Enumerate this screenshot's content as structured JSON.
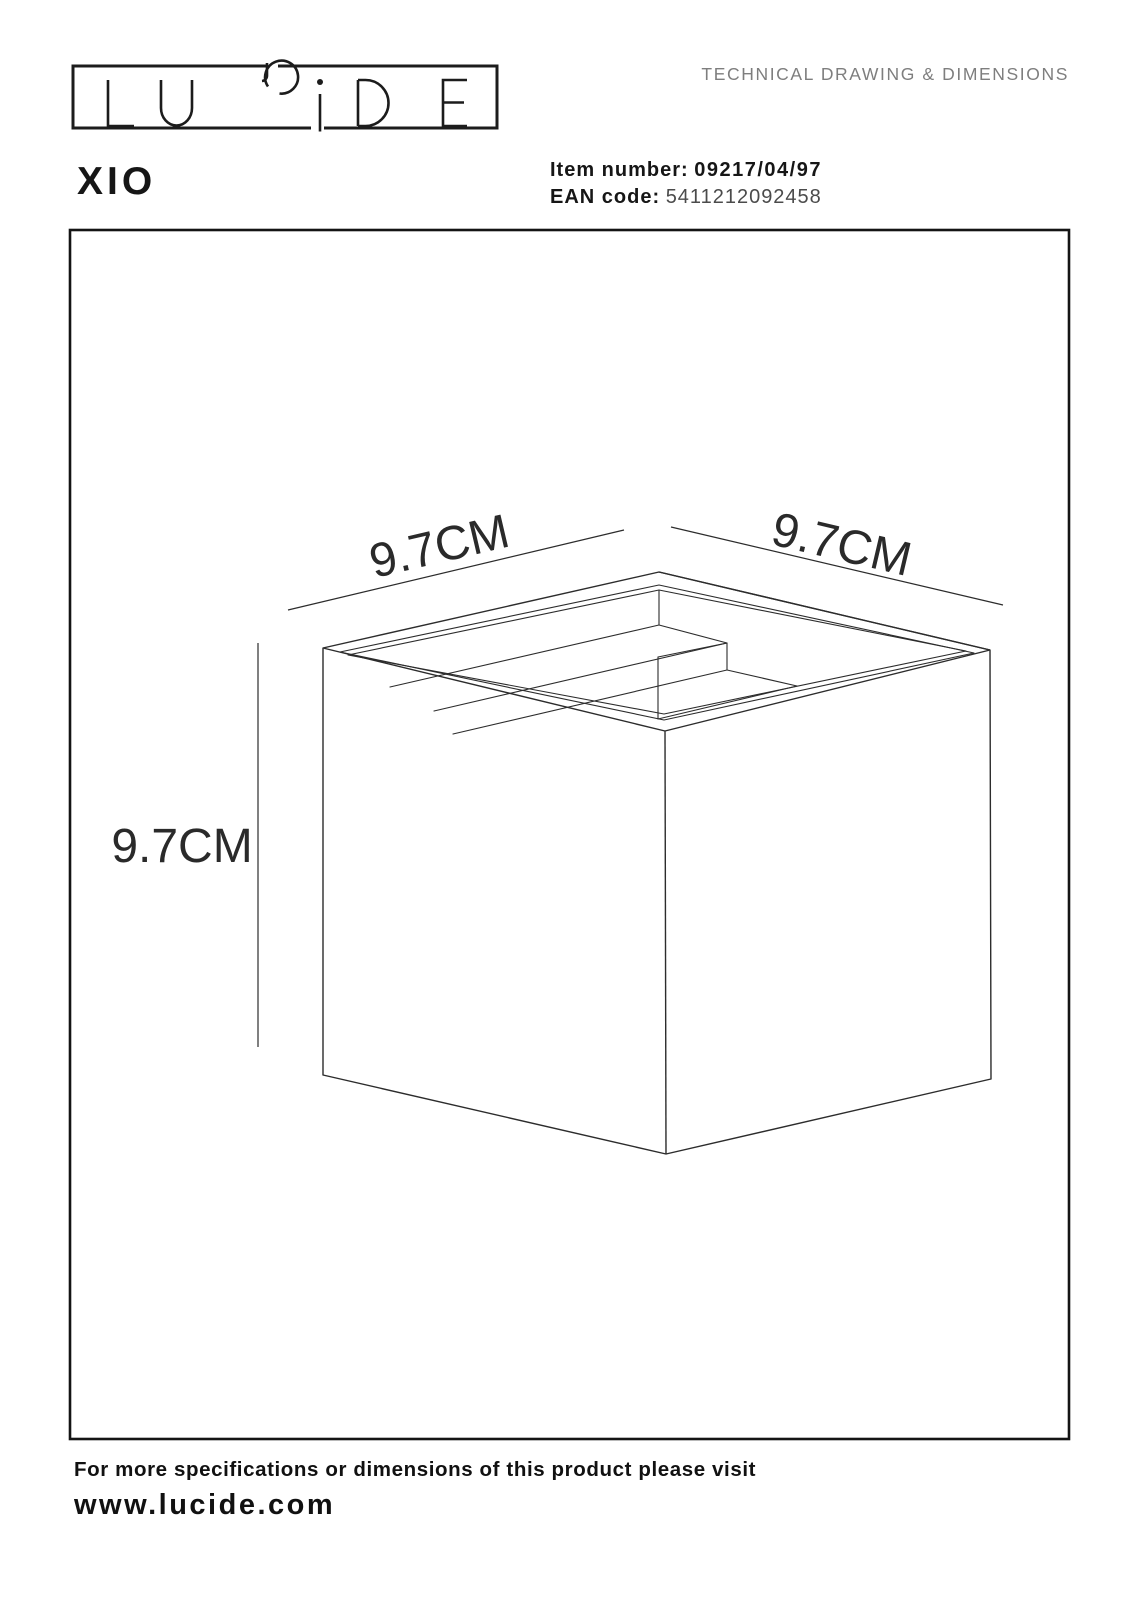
{
  "logo": {
    "text": "LUCIDE"
  },
  "header": {
    "title": "TECHNICAL DRAWING & DIMENSIONS"
  },
  "product": {
    "name": "XIO",
    "item_number_label": "Item number:",
    "item_number": "09217/04/97",
    "ean_label": "EAN code:",
    "ean_code": "5411212092458"
  },
  "drawing": {
    "width_label": "9.7CM",
    "depth_label": "9.7CM",
    "height_label": "9.7CM"
  },
  "footer": {
    "note": "For more specifications or dimensions of this product please visit",
    "website": "www.lucide.com"
  },
  "colors": {
    "ink": "#161616",
    "line": "#2c2c2c",
    "muted_title": "#7e7e7e",
    "ean_value": "#4b4b4b",
    "background": "#ffffff"
  }
}
